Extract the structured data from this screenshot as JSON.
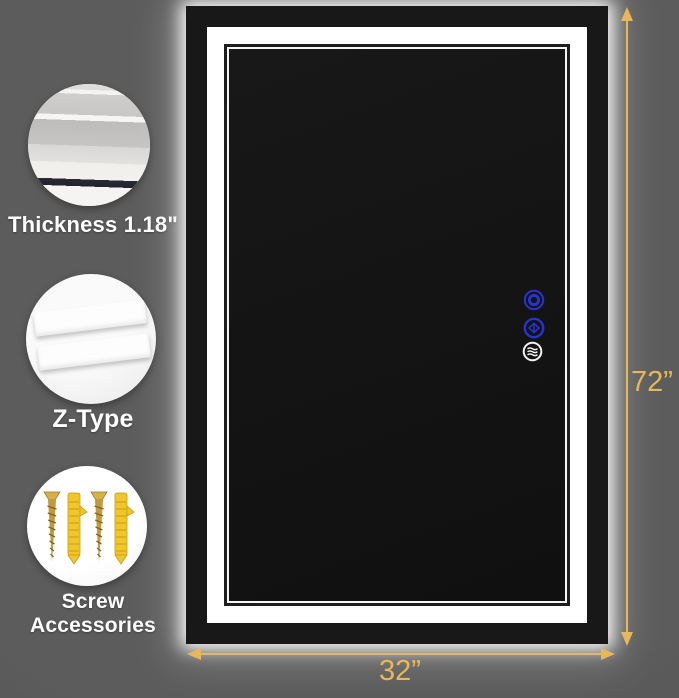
{
  "callouts": [
    {
      "label": "Thickness 1.18\"",
      "icon": "thickness-cross-section"
    },
    {
      "label": "Z-Type",
      "icon": "z-type-brackets"
    },
    {
      "label": "Screw Accessories",
      "icon": "screws-and-anchors"
    }
  ],
  "dimensions": {
    "height": "72”",
    "width": "32”"
  },
  "mirror": {
    "controls": [
      {
        "name": "power-button"
      },
      {
        "name": "color-temp-button"
      },
      {
        "name": "defog-button"
      }
    ]
  },
  "colors": {
    "dimension_gold": "#E8B757",
    "led_blue": "#2633CE",
    "glow_white": "#FFFFFF",
    "background_gray": "#565656"
  }
}
